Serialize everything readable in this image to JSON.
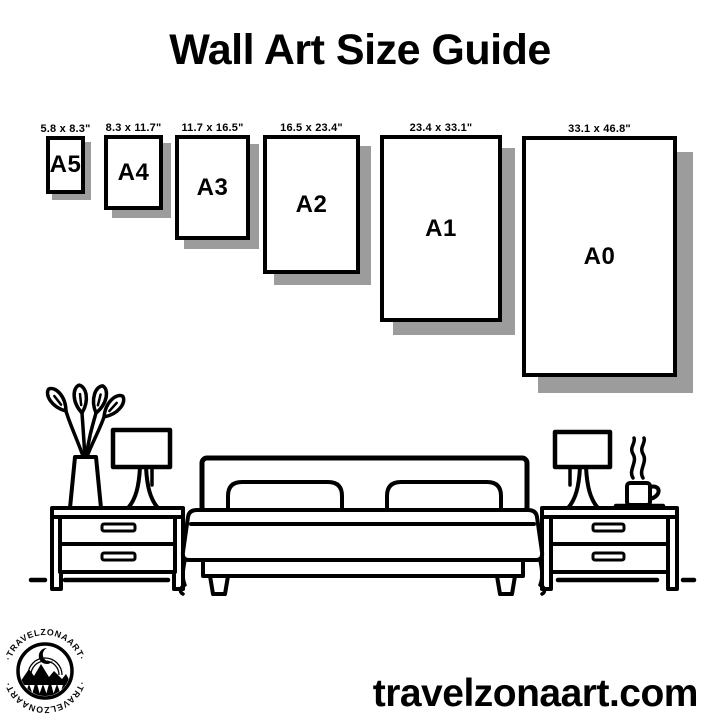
{
  "title": "Wall Art Size Guide",
  "website_url": "travelzonaart.com",
  "logo": {
    "text_top": "·TRAVELZONAART·",
    "text_bottom": "·TRAVELZONAART·"
  },
  "frames": [
    {
      "label": "A5",
      "dimensions": "5.8 x 8.3\"",
      "box": {
        "x": 46,
        "y": 136,
        "w": 39,
        "h": 58
      }
    },
    {
      "label": "A4",
      "dimensions": "8.3 x 11.7\"",
      "box": {
        "x": 104,
        "y": 135,
        "w": 59,
        "h": 75
      }
    },
    {
      "label": "A3",
      "dimensions": "11.7 x 16.5\"",
      "box": {
        "x": 175,
        "y": 135,
        "w": 75,
        "h": 105
      }
    },
    {
      "label": "A2",
      "dimensions": "16.5 x 23.4\"",
      "box": {
        "x": 263,
        "y": 135,
        "w": 97,
        "h": 139
      }
    },
    {
      "label": "A1",
      "dimensions": "23.4 x 33.1\"",
      "box": {
        "x": 380,
        "y": 135,
        "w": 122,
        "h": 187
      }
    },
    {
      "label": "A0",
      "dimensions": "33.1 x 46.8\"",
      "box": {
        "x": 522,
        "y": 136,
        "w": 155,
        "h": 241
      }
    }
  ],
  "colors": {
    "ink": "#000000",
    "shadow": "#9c9c9c",
    "background": "#ffffff"
  },
  "scene_items": [
    "plant-vase",
    "table-lamp-left",
    "nightstand-left",
    "bed-with-pillows",
    "nightstand-right",
    "table-lamp-right",
    "coffee-cup"
  ]
}
